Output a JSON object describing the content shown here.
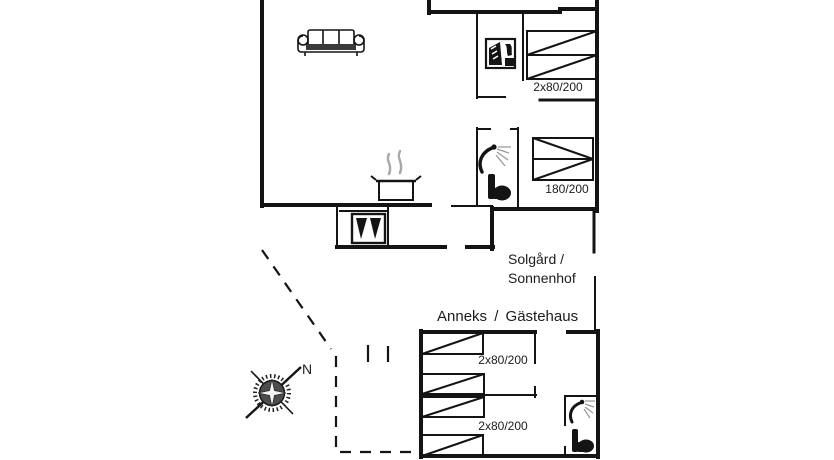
{
  "plan": {
    "main_house": {
      "name_line1": "Solgård /",
      "name_line2": "Sonnenhof",
      "bedroom1_bed_label": "2x80/200",
      "bedroom2_bed_label": "180/200"
    },
    "annex": {
      "name": "Anneks /  Gästehaus",
      "room1_bed_label": "2x80/200",
      "room2_bed_label": "2x80/200"
    },
    "compass": {
      "north_label": "N"
    },
    "icons": {
      "sofa": "sofa-icon",
      "cooking_pot": "cooking-pot-icon",
      "washing_machine": "washing-machine-icon",
      "shower": "shower-icon",
      "toilet": "toilet-icon",
      "fireplace_stove": "fireplace-stove-icon",
      "compass_rose": "compass-rose-icon"
    },
    "colors": {
      "wall": "#141414",
      "text": "#1c1c1c",
      "background": "#ffffff",
      "steam": "#a8a8a8",
      "spray": "#9a9a9a"
    }
  }
}
